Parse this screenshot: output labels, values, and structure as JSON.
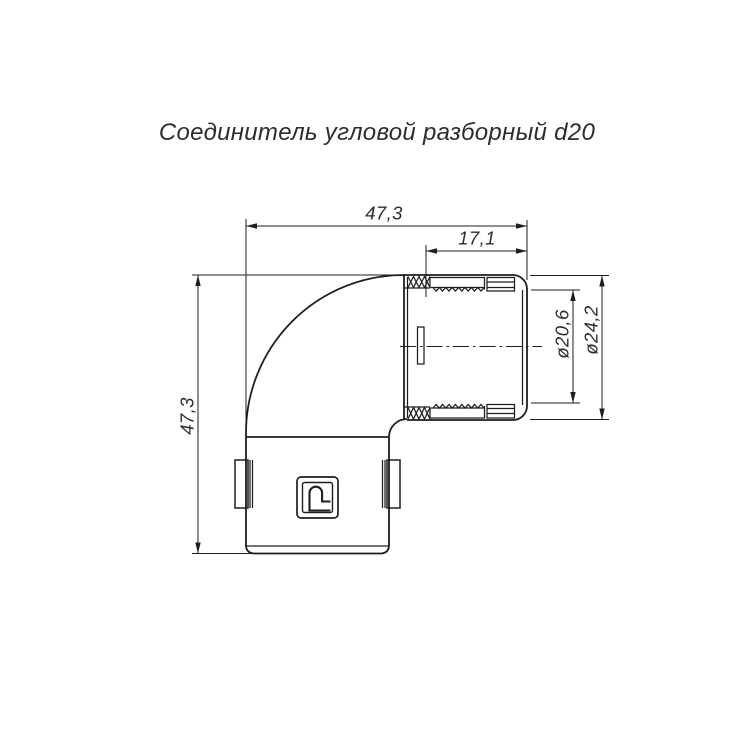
{
  "title": "Соединитель угловой разборный d20",
  "dimensions": {
    "total_width": "47,3",
    "pipe_length": "17,1",
    "total_height": "47,3",
    "inner_diameter": "ø20,6",
    "outer_diameter": "ø24,2"
  },
  "colors": {
    "line": "#1e1e1e",
    "text": "#2d2d2d",
    "background": "#ffffff"
  }
}
